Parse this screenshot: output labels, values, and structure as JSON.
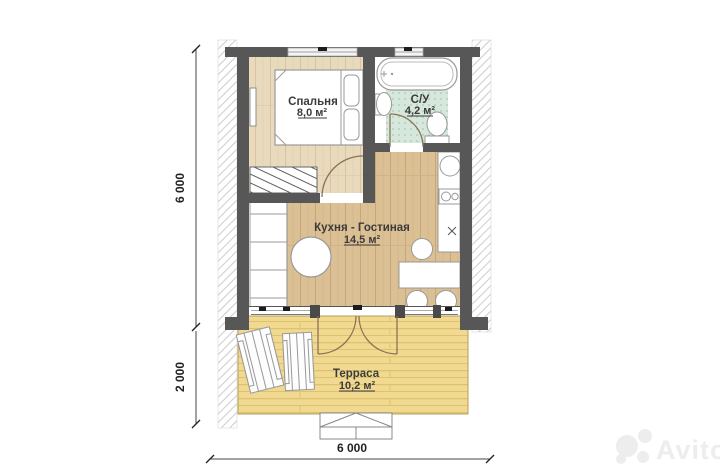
{
  "plan": {
    "rooms": {
      "bedroom": {
        "name": "Спальня",
        "area": "8,0 м²"
      },
      "bathroom": {
        "name": "С/У",
        "area": "4,2 м²"
      },
      "kitchen_living": {
        "name": "Кухня - Гостиная",
        "area": "14,5 м²"
      },
      "terrace": {
        "name": "Терраса",
        "area": "10,2 м²"
      }
    },
    "dimensions": {
      "left_house": "6 000",
      "left_terrace": "2 000",
      "bottom": "6 000"
    },
    "colors": {
      "wall": "#575757",
      "bedroom_floor": "#e9dabd",
      "kitchen_floor": "#dcc095",
      "bathroom_tile": "#d6e7db",
      "terrace_deck": "#f1da90"
    }
  },
  "watermark": {
    "brand": "Avito"
  }
}
